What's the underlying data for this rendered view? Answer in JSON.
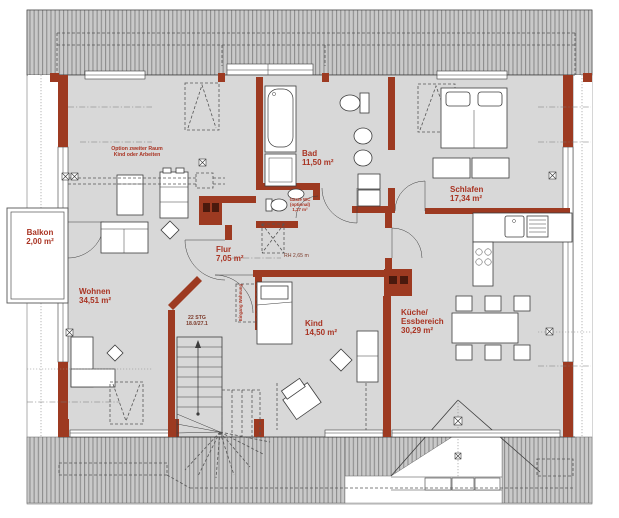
{
  "rooms": {
    "balkon": {
      "name": "Balkon",
      "area": "2,00 m²"
    },
    "wohnen": {
      "name": "Wohnen",
      "area": "34,51 m²"
    },
    "flur": {
      "name": "Flur",
      "area": "7,05 m²"
    },
    "bad": {
      "name": "Bad",
      "area": "11,50 m²"
    },
    "gaeste_wc": {
      "name": "Gäste WC",
      "note": "(optional)",
      "area": "1,27 m²"
    },
    "schlafen": {
      "name": "Schlafen",
      "area": "17,34 m²"
    },
    "kueche": {
      "name_line1": "Küche/",
      "name_line2": "Essbereich",
      "area": "30,29 m²"
    },
    "kind": {
      "name": "Kind",
      "area": "14,50 m²"
    }
  },
  "annotations": {
    "option_room_line1": "Option zweiter Raum",
    "option_room_line2": "Kind oder Arbeiten",
    "stairs_line1": "22 STG",
    "stairs_line2": "18.0/27.1",
    "room_height": "RH 2,65 m",
    "entrance_line1": "Eingang",
    "entrance_line2": "Wohnung"
  },
  "colors": {
    "wall": "#9d3a21",
    "floor": "#d8d8d8",
    "roof_fill": "#c9c9c9",
    "roof_stripe": "#8d8d8d",
    "label": "#a93322"
  }
}
